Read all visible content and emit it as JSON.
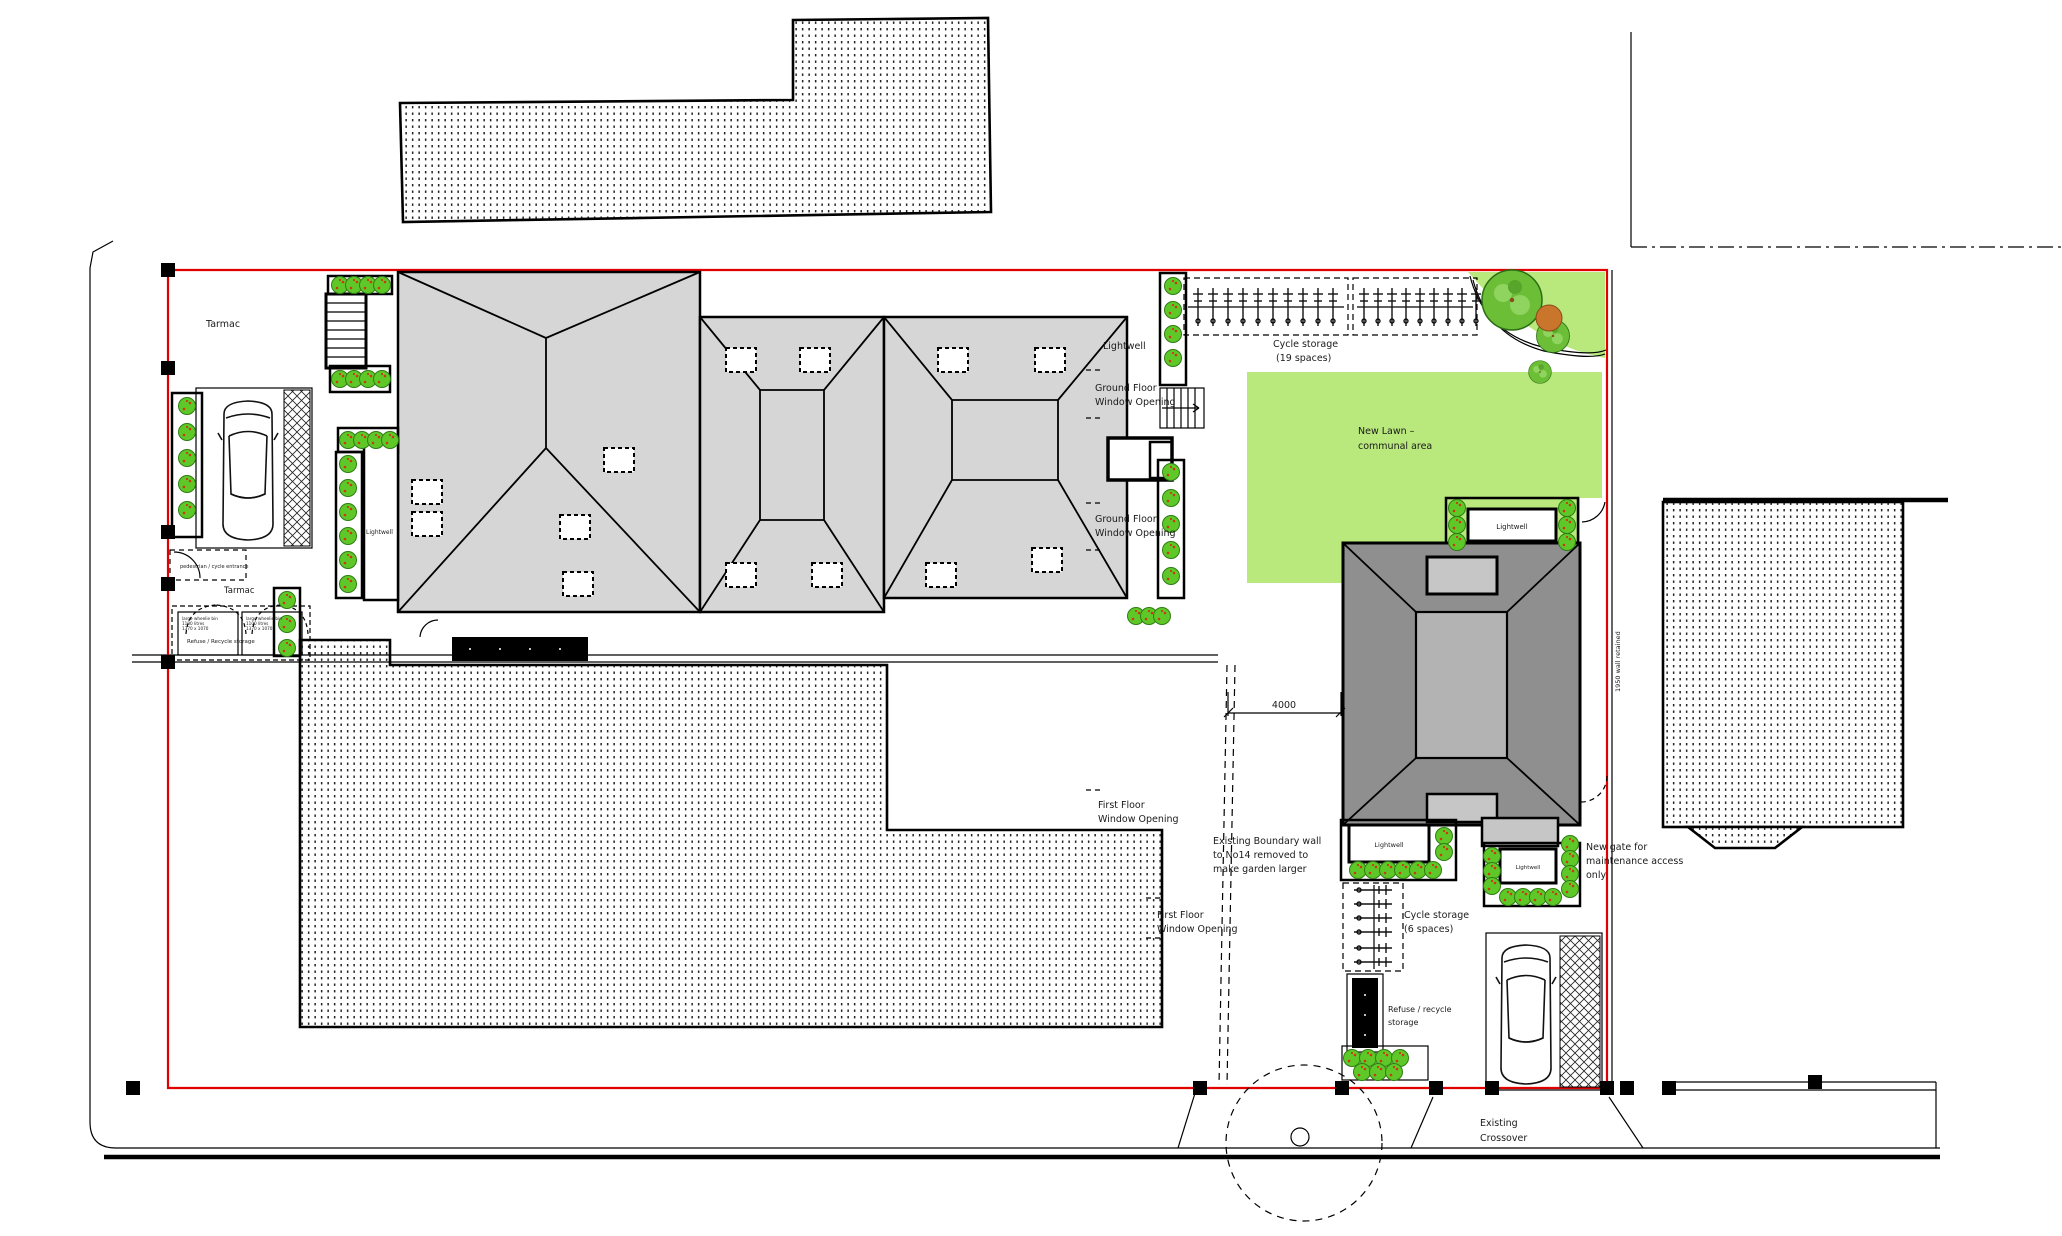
{
  "labels": {
    "tarmac_upper": "Tarmac",
    "tarmac_lower": "Tarmac",
    "pedestrian_entrance": "pedestrian / cycle entrance",
    "refuse_front": "Refuse / Recycle storage",
    "bin_box_line1": "large wheelie bin",
    "bin_box_line2": "1100 litres",
    "bin_box_line3": "1370 x 1070",
    "lightwell_left": "Lightwell",
    "lightwell_top": "Lightwell",
    "lightwell_house": "Lightwell",
    "gf_window_line1": "Ground Floor",
    "gf_window_line2": "Window Opening",
    "ff_window_line1": "First Floor",
    "ff_window_line2": "Window Opening",
    "cycle19_line1": "Cycle storage",
    "cycle19_line2": "(19 spaces)",
    "cycle6_line1": "Cycle storage",
    "cycle6_line2": "(6 spaces)",
    "lawn_line1": "New Lawn –",
    "lawn_line2": "communal area",
    "wall_retained": "1950 wall retained",
    "dim_4000": "4000",
    "boundary_line1": "Existing Boundary wall",
    "boundary_line2": "to No14 removed to",
    "boundary_line3": "make garden larger",
    "gate_line1": "New gate for",
    "gate_line2": "maintenance access",
    "gate_line3": "only",
    "refuse_right_line1": "Refuse / recycle",
    "refuse_right_line2": "storage",
    "crossover_line1": "Existing",
    "crossover_line2": "Crossover"
  },
  "colors": {
    "boundary": "#e00000",
    "lawn": "#b9e87d",
    "bush": "#5ec829",
    "building": "#d6d6d6",
    "roof_dark": "#8f8f8f",
    "roof_ridge": "#b3b3b3",
    "rooflight": "#c6c6c6"
  }
}
